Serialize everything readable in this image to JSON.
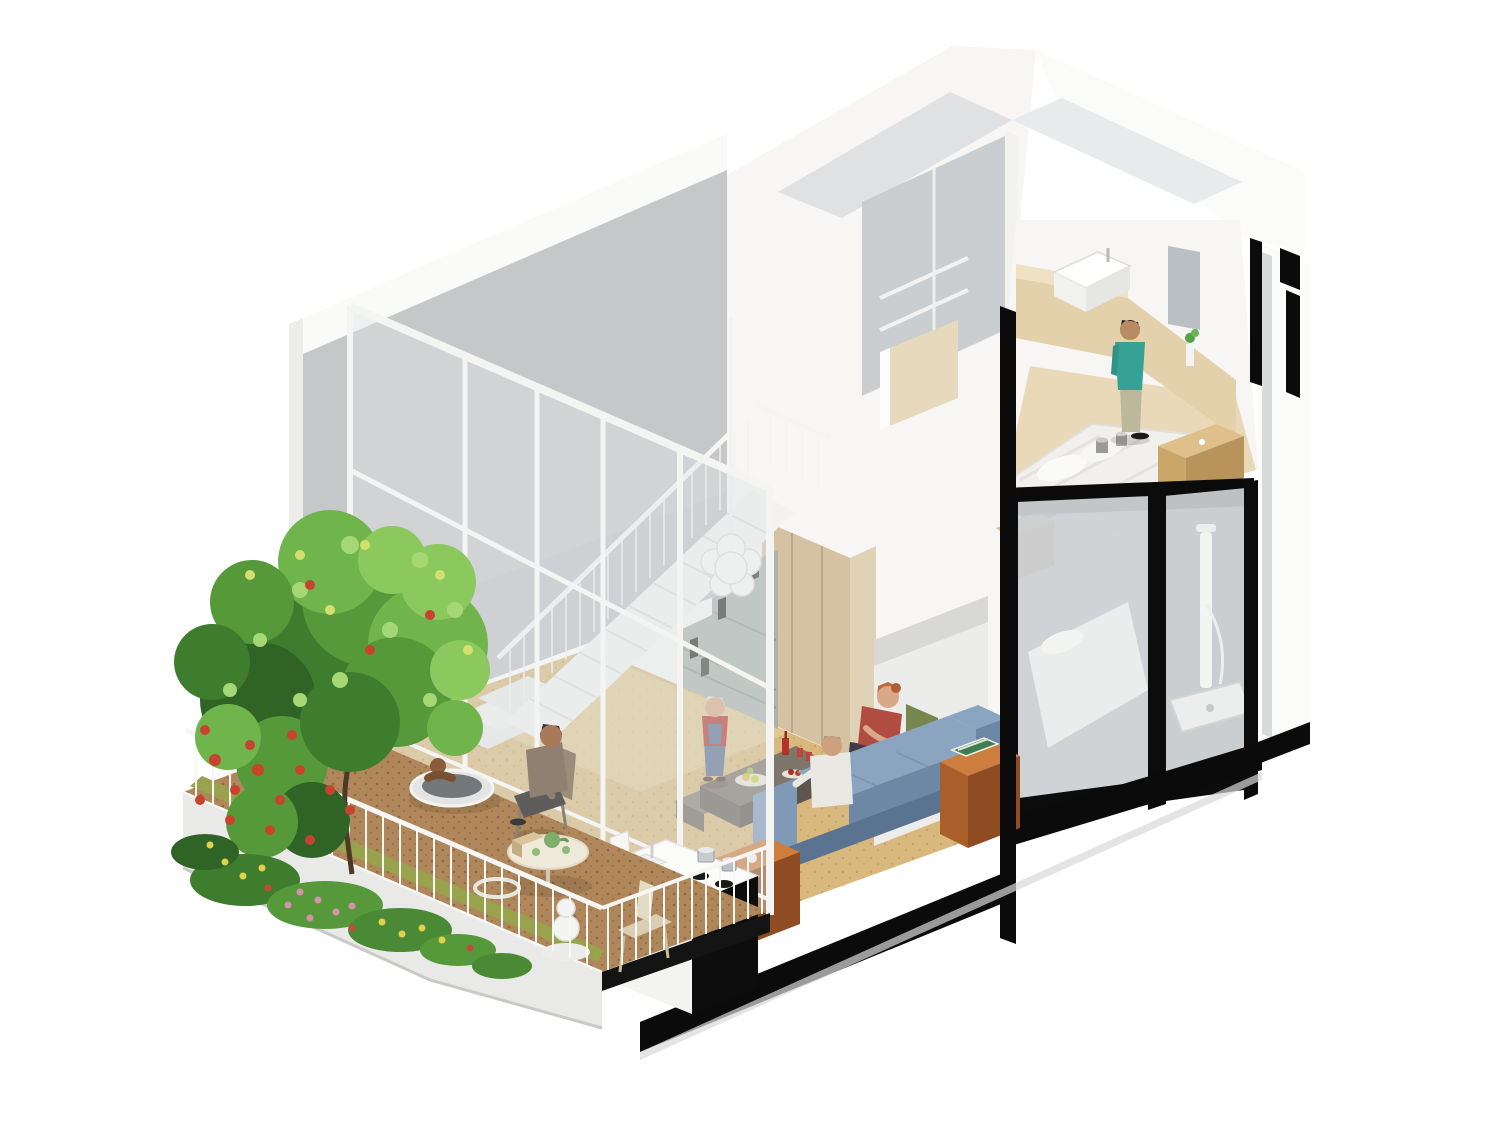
{
  "scene": {
    "type": "architectural-cutaway-render",
    "view": "isometric section of a two-storey micro-loft apartment with garden terrace",
    "background": "#ffffff"
  },
  "palette": {
    "bg": "#ffffff",
    "wall_gray": "#c6c7c9",
    "wall_white": "#f7f6f4",
    "roof_shade_a": "#e0e1e2",
    "roof_shade_b": "#e9eaeb",
    "parapet_white": "#fafaf9",
    "glass_tint": "#dfe5e8",
    "mullion_white": "#f4f5f3",
    "cork_floor": "#d8b87c",
    "deck_brown": "#b0875a",
    "moss_green": "#99a24d",
    "planter_concrete": "#e9e9e8",
    "plinth_black": "#0b0b0b",
    "bookshelf_gray": "#a9b2ac",
    "stair_white": "#f3f2f0",
    "wardrobe_wood": "#d5c2a2",
    "pendant_white": "#f9f8f6",
    "sofa_blue": "#8ba5c1",
    "sofa_blue_dark": "#6d87a5",
    "sofa_blue_deep": "#5a7390",
    "armchair_green": "#8a9c5e",
    "armchair_green_dark": "#75864f",
    "wood_cube_top": "#cd7e3e",
    "wood_cube_front": "#aa5e2a",
    "wood_cube_side": "#8f4c22",
    "coffee_table_gray": "#7e766b",
    "travertine": "#e3d1ab",
    "bed_white": "#f1f0ed",
    "nightstand_wood": "#ddbd80",
    "lower_glass": "#cdd0d3",
    "shower_white": "#f4f4f3",
    "mirror_gray": "#b9c0c4",
    "railing_white": "#f6f6f4",
    "tree_green_dark": "#2f6426",
    "tree_green": "#3f7d2e",
    "tree_green_mid": "#55993a",
    "tree_green_bright": "#6fb54b",
    "tree_green_light": "#8bc95f",
    "tree_green_pale": "#a5d874",
    "flower_red": "#c8432e",
    "flower_pink": "#d690ac",
    "flower_yellow": "#e2cf4e",
    "skin": "#d9a886",
    "skin_tan": "#a9795a",
    "teal_shirt": "#35a295",
    "red_top": "#b04c42",
    "child_red": "#b7372a",
    "overalls_blue": "#5d6f92",
    "terrace_shirt": "#8f8071",
    "white_shirt": "#eae8e2",
    "teapot_green": "#7fae6a"
  },
  "rooms": [
    {
      "name": "garden-terrace",
      "level": "ground",
      "features": [
        "concrete planter wedge",
        "flowering tree",
        "white baluster railing",
        "round soaking tub",
        "bistro table with green tea set",
        "timber deck"
      ]
    },
    {
      "name": "living-room",
      "level": "ground",
      "features": [
        "double-height void",
        "glazed partition with white mullions",
        "cork floor",
        "blue sofa",
        "concrete coffee table with fruit",
        "timber side cubes"
      ]
    },
    {
      "name": "kitchenette",
      "level": "ground",
      "features": [
        "white counter with sink",
        "black counter front",
        "cooktop with two pots"
      ]
    },
    {
      "name": "staircase",
      "level": "ground-to-upper",
      "features": [
        "white winder stair",
        "thin baluster guardrail",
        "stepped grey bookshelf underneath",
        "white cluster pendant lamp"
      ]
    },
    {
      "name": "upper-bathroom",
      "level": "upper",
      "features": [
        "white basin on travertine counter",
        "grey mirror door",
        "grey glass shower doors",
        "small plant"
      ]
    },
    {
      "name": "upper-bedroom",
      "level": "upper",
      "features": [
        "white double bed",
        "timber nightstand boxes",
        "two cups",
        "magazine"
      ]
    },
    {
      "name": "lower-bedroom",
      "level": "ground",
      "features": [
        "bed behind grey glazing",
        "black framed glass front"
      ]
    },
    {
      "name": "lower-shower",
      "level": "ground",
      "features": [
        "white shower column",
        "shower tray"
      ]
    }
  ],
  "people": [
    {
      "name": "woman-red-top",
      "where": "seated in green armchair in living room"
    },
    {
      "name": "man-white-shirt",
      "where": "seated at coffee table on sofa side"
    },
    {
      "name": "child-overalls",
      "where": "standing beside coffee table"
    },
    {
      "name": "man-terrace",
      "where": "seated at terrace bistro table"
    },
    {
      "name": "person-in-tub",
      "where": "round soaking tub on terrace"
    },
    {
      "name": "person-teal-shirt",
      "where": "standing in upper bedroom by bathroom counter"
    }
  ],
  "vegetation": {
    "tree": "large shrub-tree with red blossoms and yellow-green highlights",
    "border": "mixed flowering underplanting with pink, yellow and red blooms",
    "moss": "moss strip along planter edge"
  }
}
